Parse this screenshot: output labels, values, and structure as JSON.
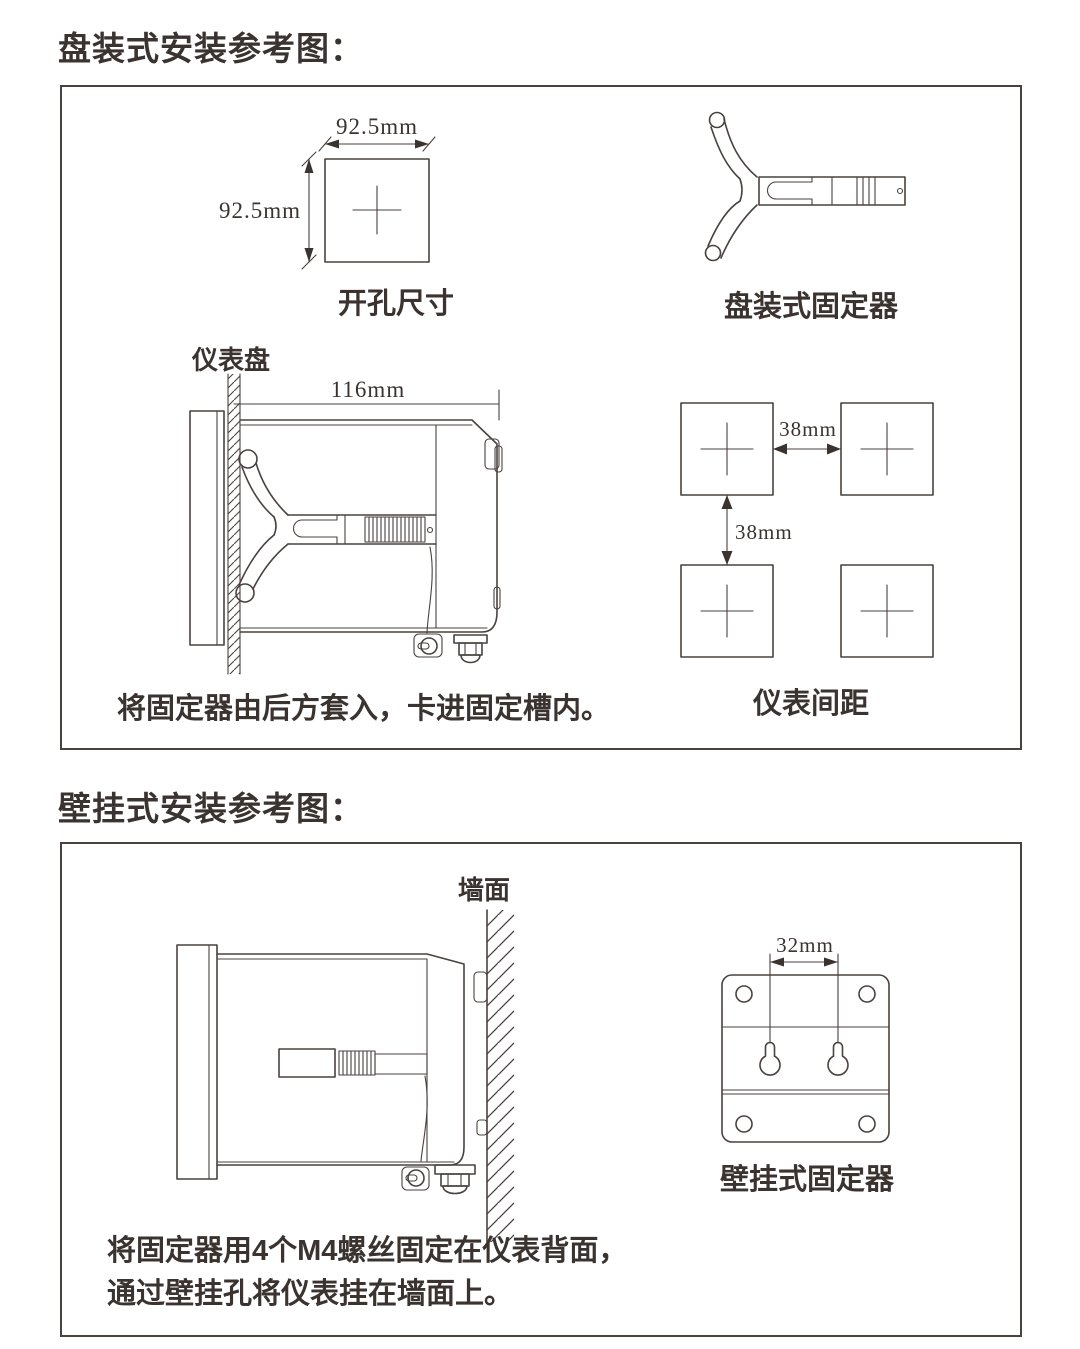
{
  "panel_section": {
    "title": "盘装式安装参考图：",
    "cutout": {
      "width_label": "92.5mm",
      "height_label": "92.5mm",
      "caption": "开孔尺寸"
    },
    "fixer_caption": "盘装式固定器",
    "side_view": {
      "panel_label": "仪表盘",
      "depth_label": "116mm",
      "caption": "将固定器由后方套入，卡进固定槽内。"
    },
    "spacing": {
      "h_label": "38mm",
      "v_label": "38mm",
      "caption": "仪表间距"
    }
  },
  "wall_section": {
    "title": "壁挂式安装参考图：",
    "wall_label": "墙面",
    "bracket": {
      "dim_label": "32mm",
      "caption": "壁挂式固定器"
    },
    "caption_line1": "将固定器用4个M4螺丝固定在仪表背面，",
    "caption_line2": "通过壁挂孔将仪表挂在墙面上。"
  },
  "colors": {
    "line": "#4a423f",
    "text": "#3a3330"
  }
}
